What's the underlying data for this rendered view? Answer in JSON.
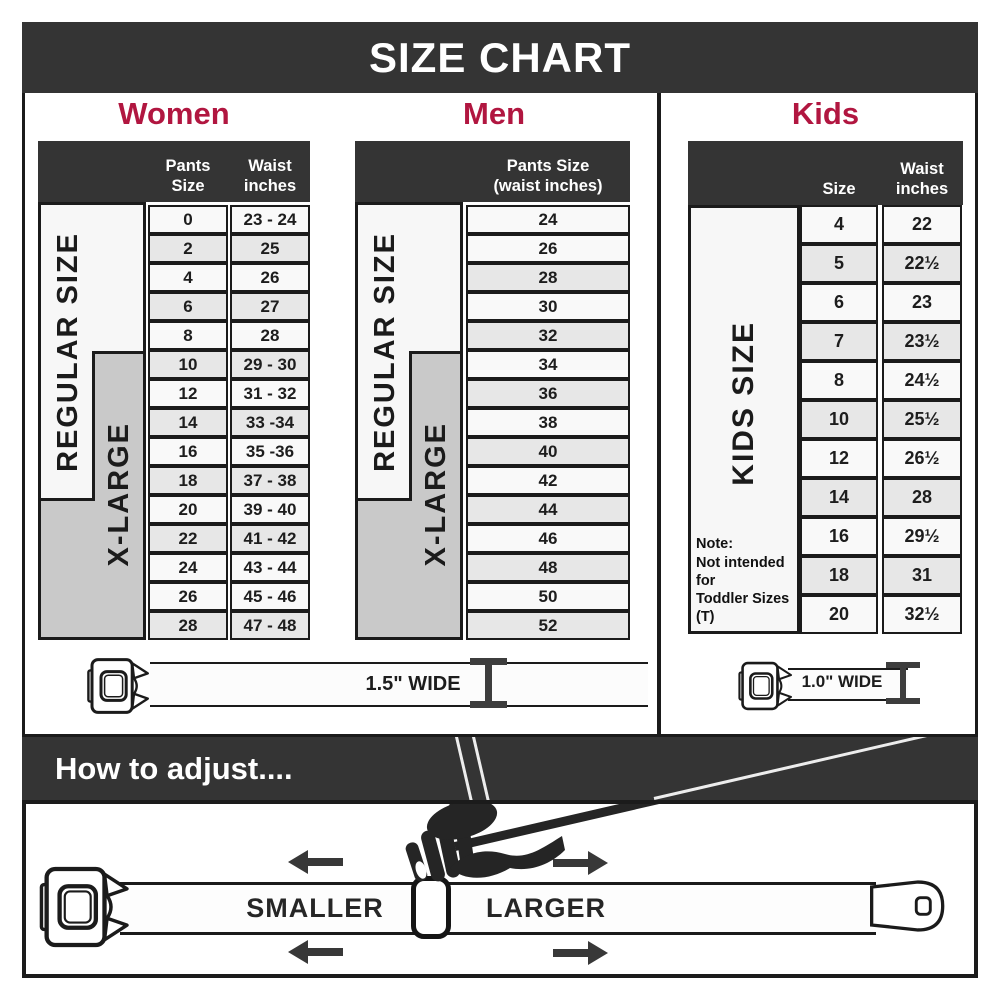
{
  "title": "SIZE CHART",
  "colors": {
    "accent": "#b11640",
    "banner": "#343434",
    "shaded_row": "#e7e7e7",
    "label_gray": "#c9c9c9"
  },
  "women": {
    "heading": "Women",
    "pants_header": "Pants Size",
    "waist_header_line1": "Waist",
    "waist_header_line2": "inches",
    "regular_label": "REGULAR SIZE",
    "xlarge_label": "X-LARGE",
    "belt_width_label": "1.5\" WIDE",
    "rows": [
      {
        "size": "0",
        "waist": "23 - 24",
        "shaded": false
      },
      {
        "size": "2",
        "waist": "25",
        "shaded": true
      },
      {
        "size": "4",
        "waist": "26",
        "shaded": false
      },
      {
        "size": "6",
        "waist": "27",
        "shaded": true
      },
      {
        "size": "8",
        "waist": "28",
        "shaded": false
      },
      {
        "size": "10",
        "waist": "29 - 30",
        "shaded": true
      },
      {
        "size": "12",
        "waist": "31 - 32",
        "shaded": false
      },
      {
        "size": "14",
        "waist": "33 -34",
        "shaded": true
      },
      {
        "size": "16",
        "waist": "35 -36",
        "shaded": false
      },
      {
        "size": "18",
        "waist": "37 - 38",
        "shaded": true
      },
      {
        "size": "20",
        "waist": "39 - 40",
        "shaded": false
      },
      {
        "size": "22",
        "waist": "41 - 42",
        "shaded": true
      },
      {
        "size": "24",
        "waist": "43 - 44",
        "shaded": false
      },
      {
        "size": "26",
        "waist": "45 - 46",
        "shaded": false
      },
      {
        "size": "28",
        "waist": "47 - 48",
        "shaded": true
      }
    ]
  },
  "men": {
    "heading": "Men",
    "header_line1": "Pants Size",
    "header_line2": "(waist inches)",
    "regular_label": "REGULAR SIZE",
    "xlarge_label": "X-LARGE",
    "rows": [
      {
        "size": "24",
        "shaded": false
      },
      {
        "size": "26",
        "shaded": false
      },
      {
        "size": "28",
        "shaded": true
      },
      {
        "size": "30",
        "shaded": false
      },
      {
        "size": "32",
        "shaded": true
      },
      {
        "size": "34",
        "shaded": false
      },
      {
        "size": "36",
        "shaded": true
      },
      {
        "size": "38",
        "shaded": false
      },
      {
        "size": "40",
        "shaded": true
      },
      {
        "size": "42",
        "shaded": false
      },
      {
        "size": "44",
        "shaded": true
      },
      {
        "size": "46",
        "shaded": false
      },
      {
        "size": "48",
        "shaded": true
      },
      {
        "size": "50",
        "shaded": false
      },
      {
        "size": "52",
        "shaded": true
      }
    ]
  },
  "kids": {
    "heading": "Kids",
    "size_header": "Size",
    "waist_header_line1": "Waist",
    "waist_header_line2": "inches",
    "side_label": "KIDS SIZE",
    "note_title": "Note:",
    "note_line1": "Not intended for",
    "note_line2": "Toddler Sizes (T)",
    "belt_width_label": "1.0\" WIDE",
    "rows": [
      {
        "size": "4",
        "waist": "22",
        "shaded": false
      },
      {
        "size": "5",
        "waist": "22½",
        "shaded": true
      },
      {
        "size": "6",
        "waist": "23",
        "shaded": false
      },
      {
        "size": "7",
        "waist": "23½",
        "shaded": true
      },
      {
        "size": "8",
        "waist": "24½",
        "shaded": false
      },
      {
        "size": "10",
        "waist": "25½",
        "shaded": true
      },
      {
        "size": "12",
        "waist": "26½",
        "shaded": false
      },
      {
        "size": "14",
        "waist": "28",
        "shaded": true
      },
      {
        "size": "16",
        "waist": "29½",
        "shaded": false
      },
      {
        "size": "18",
        "waist": "31",
        "shaded": true
      },
      {
        "size": "20",
        "waist": "32½",
        "shaded": false
      }
    ]
  },
  "adjust": {
    "heading": "How to adjust....",
    "smaller_label": "SMALLER",
    "larger_label": "LARGER"
  }
}
